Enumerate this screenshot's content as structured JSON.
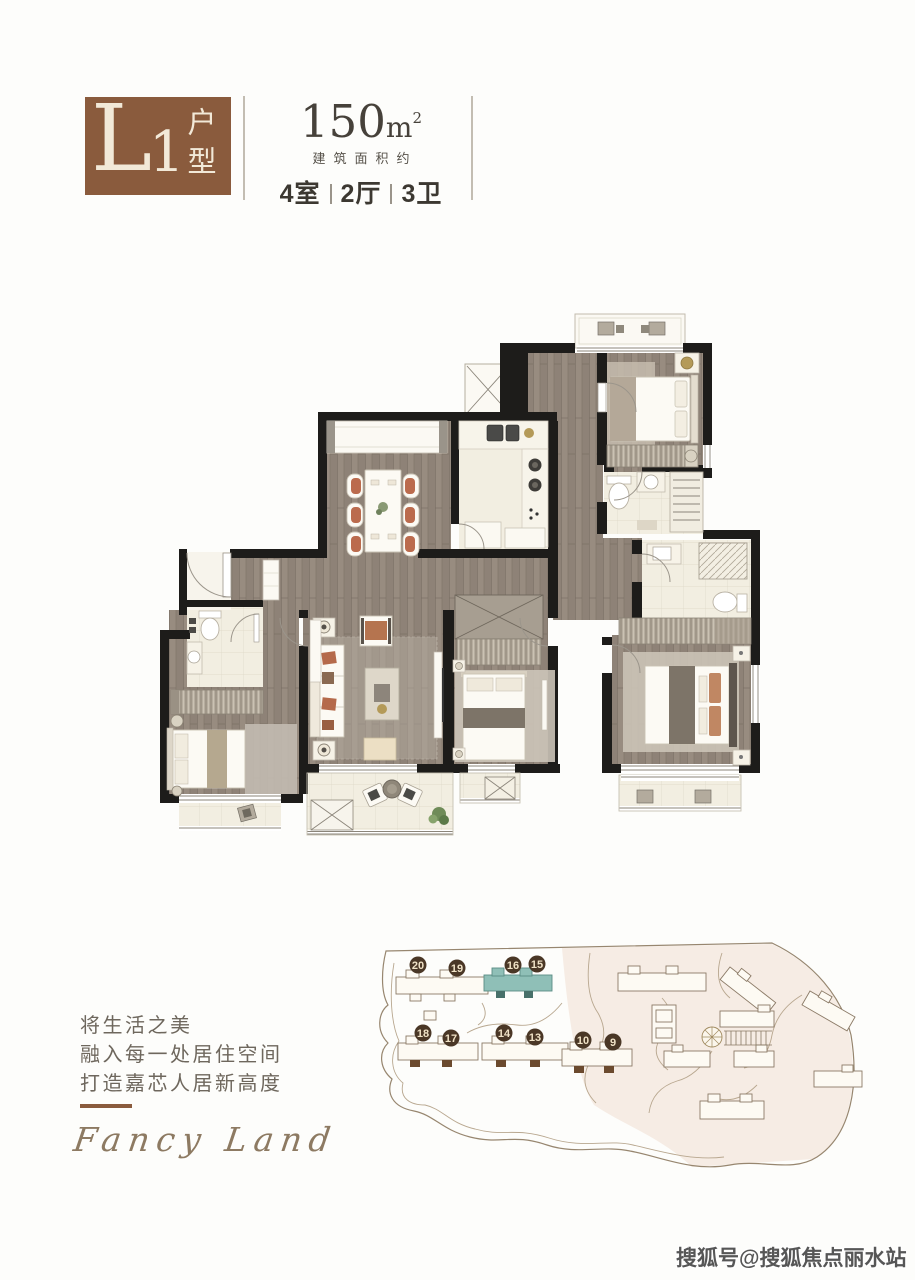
{
  "header": {
    "unit_letter": "L",
    "unit_number": "1",
    "unit_type": "户型",
    "area_value": "150",
    "area_unit": "m",
    "area_exponent": "2",
    "area_label": "建筑面积约",
    "rooms": "4室",
    "halls": "2厅",
    "baths": "3卫"
  },
  "tagline": {
    "line1": "将生活之美",
    "line2": "融入每一处居住空间",
    "line3": "打造嘉芯人居新高度",
    "signature": "Fancy Land"
  },
  "sitemap": {
    "markers": [
      "20",
      "19",
      "16",
      "15",
      "18",
      "17",
      "14",
      "13",
      "10",
      "9"
    ],
    "highlight_color": "#8fbfb7",
    "marker_color": "#4a3726"
  },
  "watermark": "搜狐号@搜狐焦点丽水站",
  "colors": {
    "accent_brown": "#8a5b3d",
    "wall_black": "#1d1c1a",
    "wood_floor": "#8e8277"
  }
}
